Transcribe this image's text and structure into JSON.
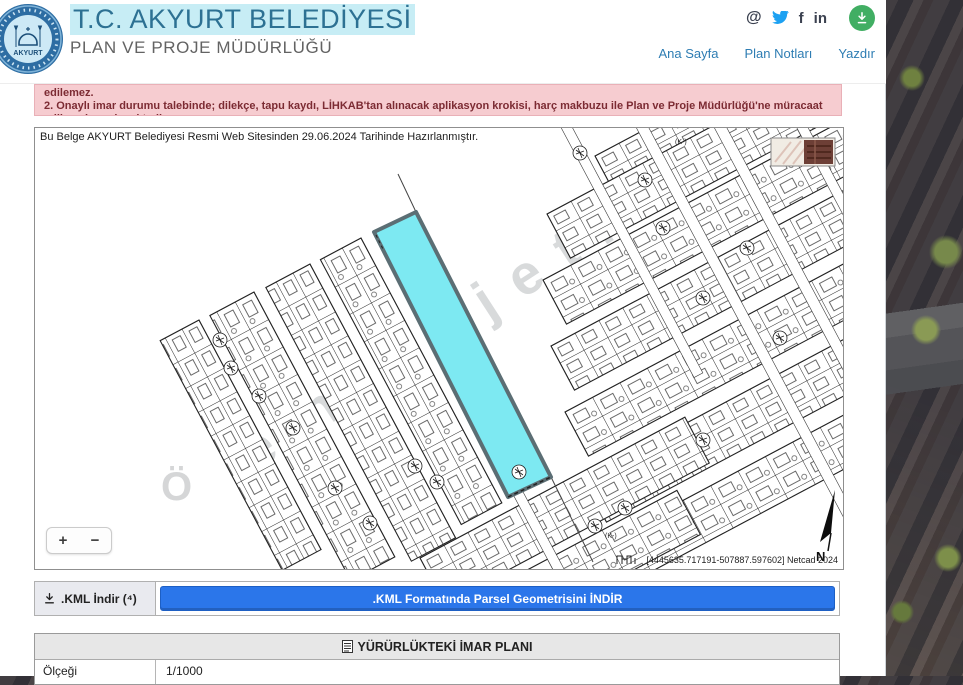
{
  "header": {
    "title": "T.C. AKYURT BELEDİYESİ",
    "subtitle": "PLAN VE PROJE MÜDÜRLÜĞÜ",
    "social": {
      "at": "@",
      "facebook": "f",
      "linkedin": "in"
    },
    "nav": [
      {
        "label": "Ana Sayfa"
      },
      {
        "label": "Plan Notları"
      },
      {
        "label": "Yazdır"
      }
    ]
  },
  "alert": {
    "line1": "edilemez.",
    "line2": "2. Onaylı imar durumu talebinde; dilekçe, tapu kaydı, LİHKAB'tan alınacak aplikasyon krokisi, harç makbuzu ile Plan ve Proje Müdürlüğü'ne müracaat edilmesi gerekmektedir."
  },
  "map": {
    "notice": "Bu Belge AKYURT Belediyesi Resmi Web Sitesinden 29.06.2024 Tarihinde Hazırlanmıştır.",
    "watermark": "emlakjet.com",
    "watermark_letter": "Ö",
    "k_label": "(K-)",
    "north_label": "N",
    "coords": "[4445635.717191-507887.597602] Netcad 2024",
    "zoom_in": "+",
    "zoom_out": "−"
  },
  "kml": {
    "label": ".KML İndir (⁴)",
    "button_label": ".KML Formatında Parsel Geometrisini İNDİR"
  },
  "table": {
    "header": "YÜRÜRLÜKTEKİ İMAR PLANI",
    "rows": [
      {
        "label": "Ölçeği",
        "value": "1/1000"
      }
    ]
  },
  "colors": {
    "accent_blue": "#2e7db3",
    "button_blue": "#2b76ea",
    "parcel_cyan": "#7de9f2",
    "alert_bg": "#f6ccd0",
    "alert_text": "#7c2b33",
    "download_green": "#41ae63",
    "twitter_blue": "#1da1f2"
  }
}
